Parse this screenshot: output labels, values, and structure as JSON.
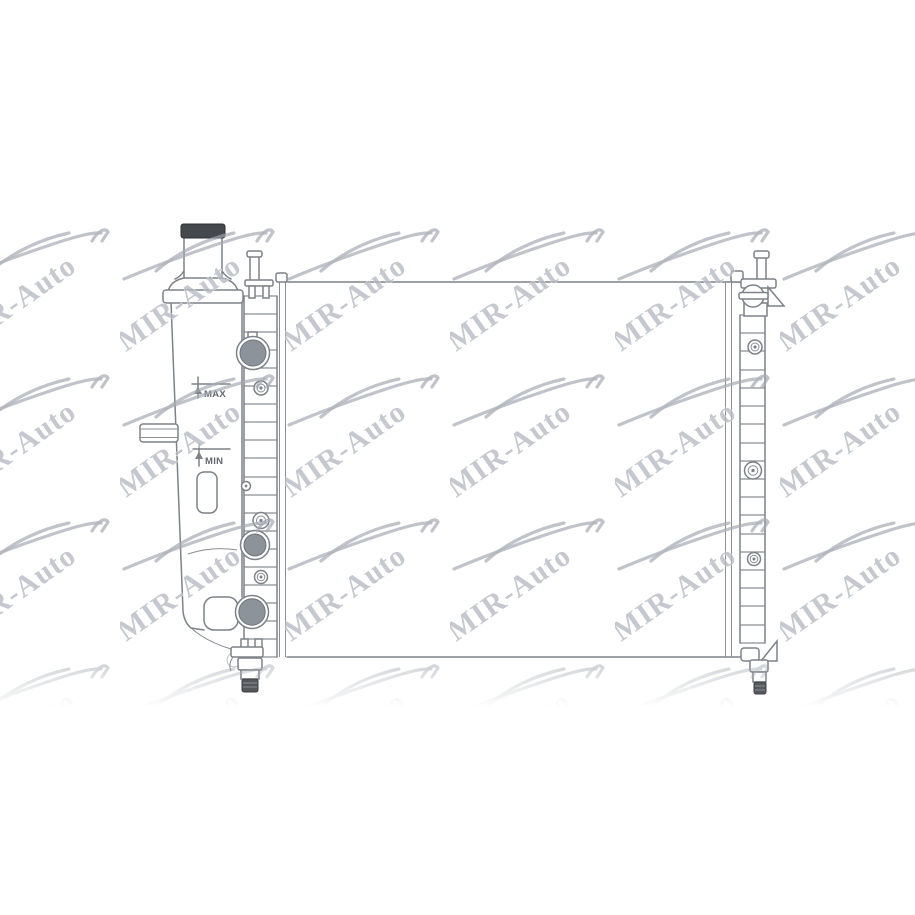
{
  "image": {
    "width": 915,
    "height": 915,
    "background": "#ffffff"
  },
  "watermark": {
    "text": "MIR-Auto",
    "logo_icon": "car-silhouette-icon",
    "text_color": "#b3b9c0",
    "emboss_color": "#ffffff",
    "car_color": "#a3a9b1",
    "rotation_deg": -35,
    "tile_width": 165,
    "tile_height": 150,
    "columns_x": [
      -45,
      120,
      285,
      450,
      615,
      780
    ],
    "rows_y": [
      224,
      370,
      514,
      660
    ]
  },
  "diagram": {
    "subject": "car radiator with expansion tank — technical line drawing",
    "labels": {
      "max": "MAX",
      "min": "MIN"
    },
    "label_color": "#63676d",
    "line_color": "#7d8288",
    "rib_line_color": "#8a8f95",
    "disk_fill": "#8d939a",
    "cap_fill": "#45484c",
    "plug_fill": "#54575b"
  }
}
